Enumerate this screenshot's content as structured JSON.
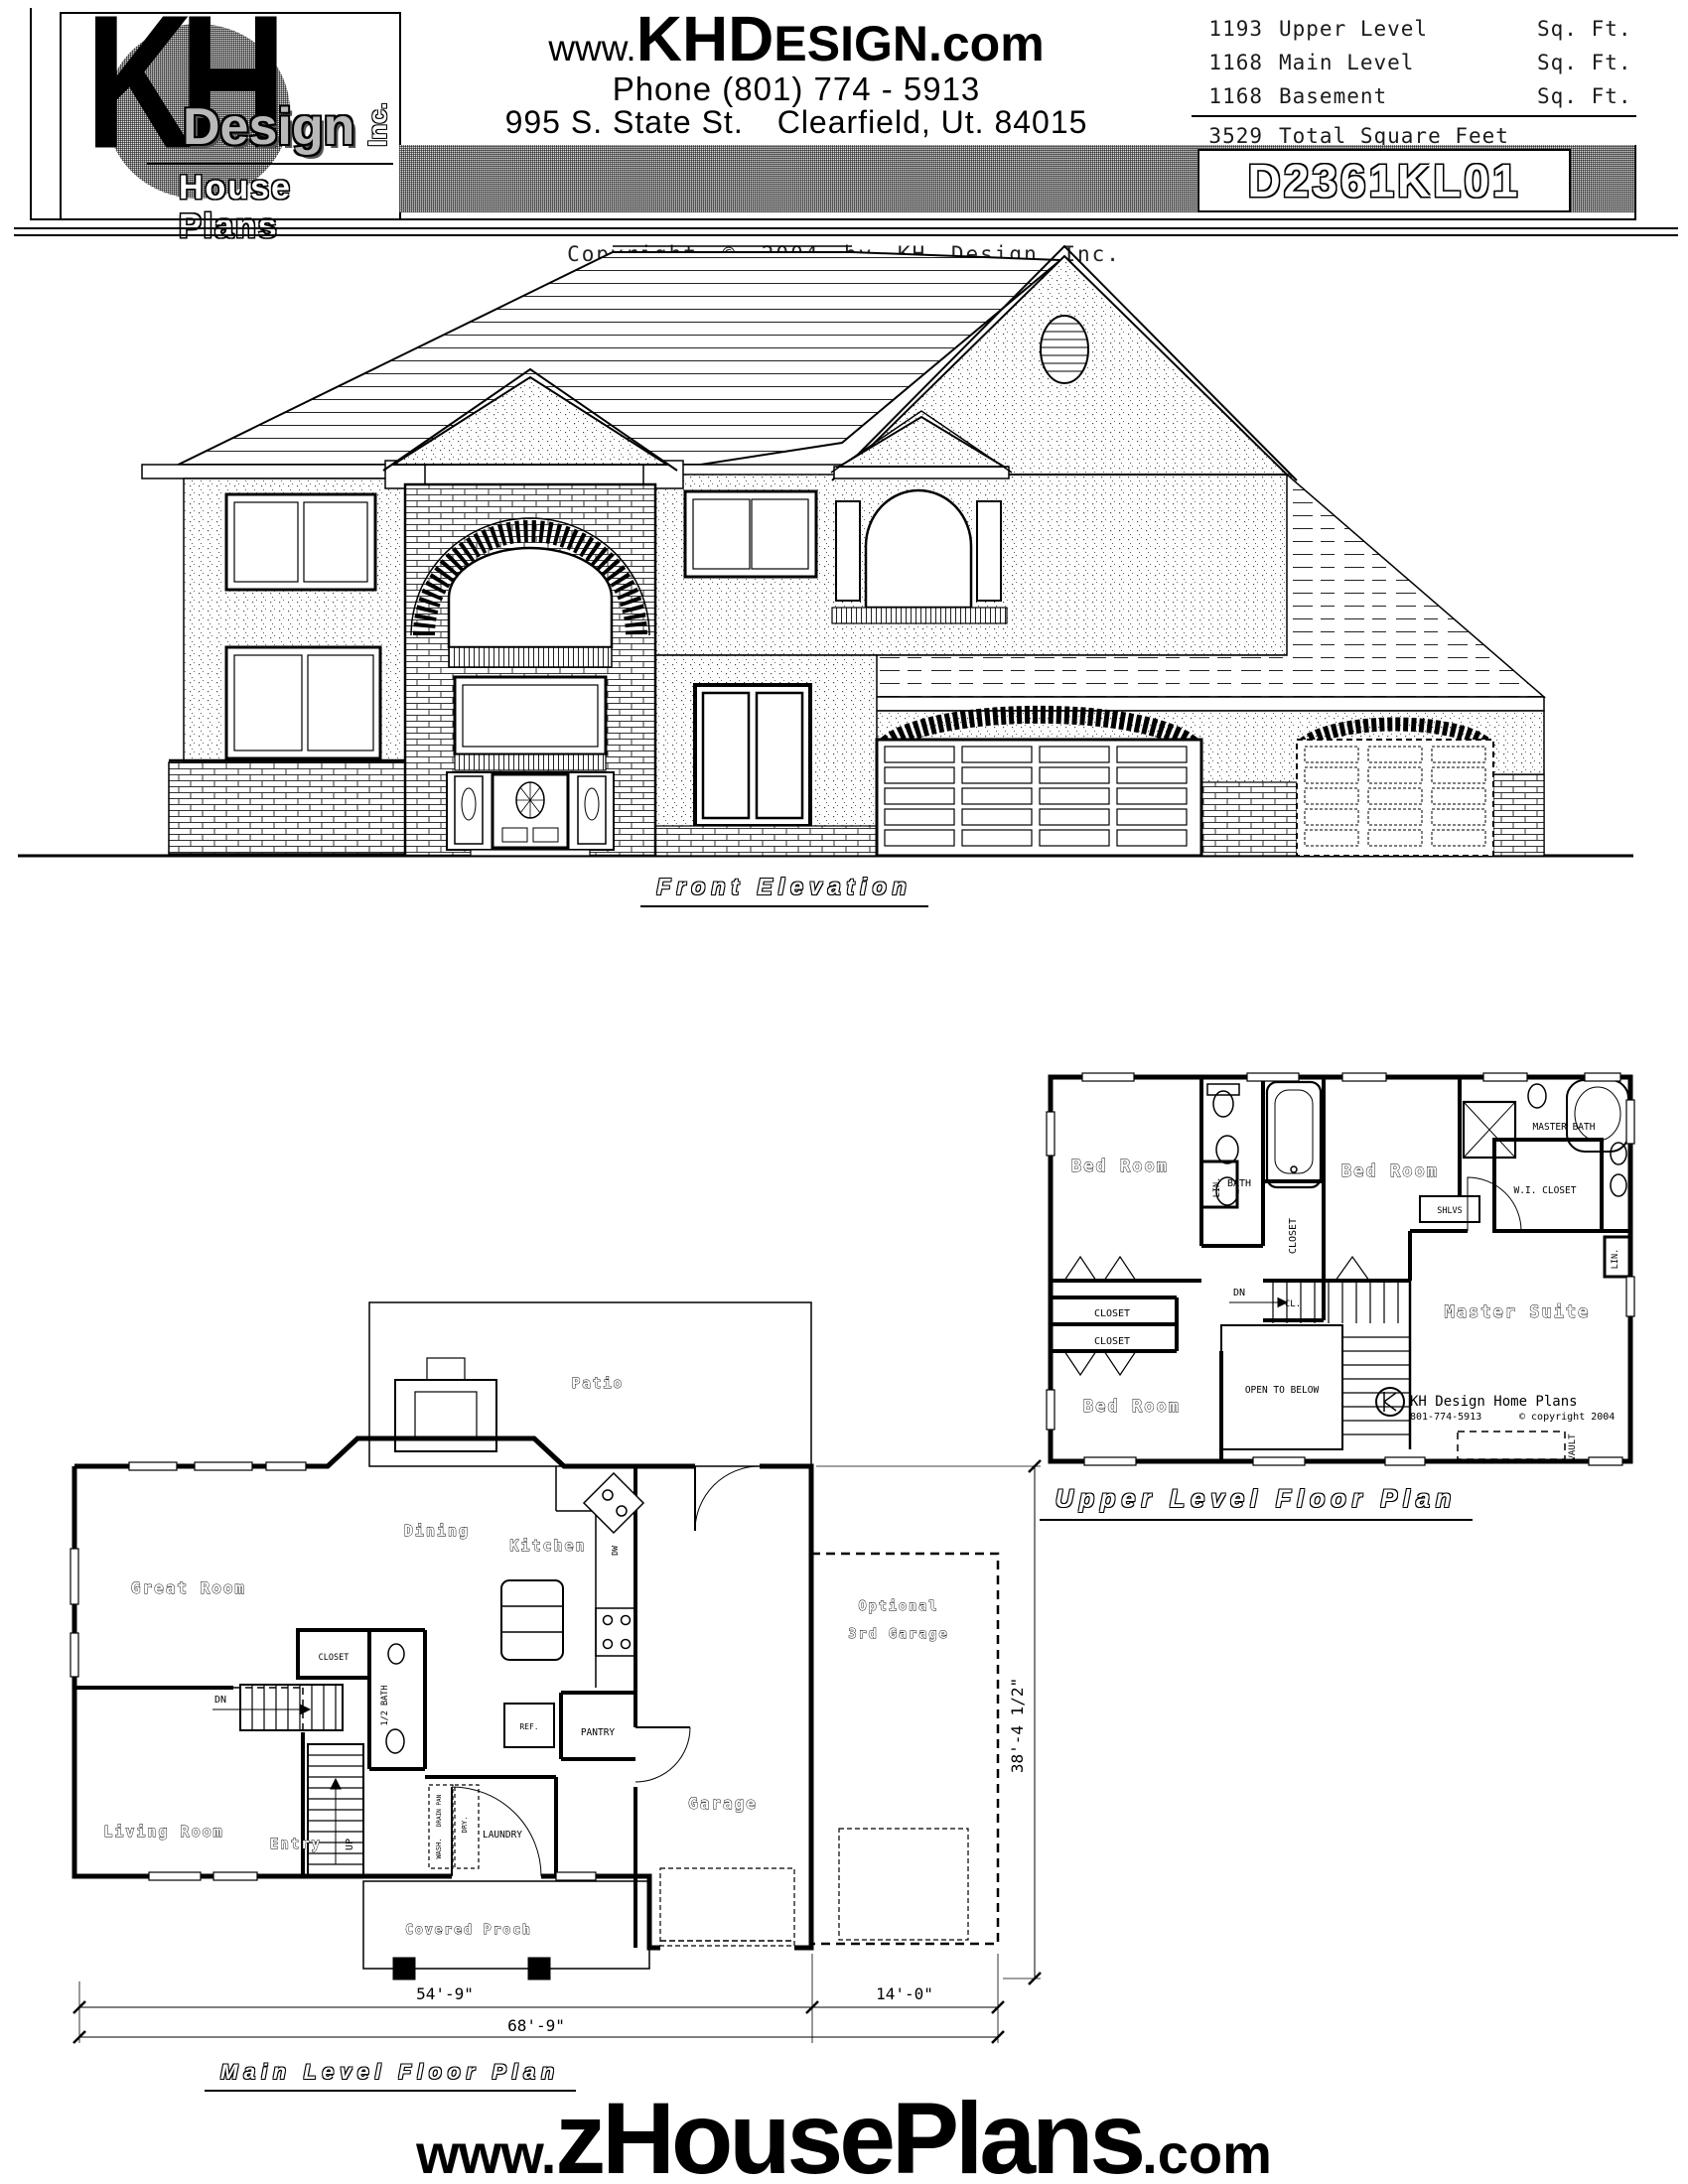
{
  "header": {
    "logo": {
      "kh": "KH",
      "design": "Design",
      "inc": "Inc.",
      "tagline": "House Plans"
    },
    "website": {
      "www": "www.",
      "khd": "KHD",
      "esign": "ESIGN",
      "com": ".com"
    },
    "phone": "Phone (801) 774 - 5913",
    "address_street": "995 S. State St.",
    "address_city": "Clearfield, Ut. 84015",
    "sqft": {
      "rows": [
        {
          "v": "1193",
          "label": "Upper Level",
          "unit": "Sq. Ft."
        },
        {
          "v": "1168",
          "label": "Main Level",
          "unit": "Sq. Ft."
        },
        {
          "v": "1168",
          "label": "Basement",
          "unit": "Sq. Ft."
        }
      ],
      "total": {
        "v": "3529",
        "label": "Total Square Feet"
      }
    },
    "plan_number": "D2361KL01"
  },
  "copyright": "Copyright © 2004 by KH Design Inc.",
  "elevation": {
    "caption": "Front Elevation"
  },
  "upper_plan": {
    "caption": "Upper Level Floor Plan",
    "rooms": {
      "bed_room": "Bed Room",
      "master_suite": "Master Suite",
      "bath": "BATH",
      "master_bath": "MASTER BATH",
      "wi_closet": "W.I. CLOSET",
      "closet": "CLOSET",
      "cl": "CL.",
      "lin": "LIN.",
      "shlvs": "SHLVS",
      "dn": "DN",
      "open_below": "OPEN TO BELOW",
      "vault": "VAULT"
    },
    "branding": {
      "name": "KH Design Home Plans",
      "phone": "801-774-5913",
      "copy": "© copyright 2004"
    }
  },
  "main_plan": {
    "caption": "Main Level Floor Plan",
    "rooms": {
      "patio": "Patio",
      "dining": "Dining",
      "kitchen": "Kitchen",
      "great_room": "Great Room",
      "living_room": "Living Room",
      "entry": "Entry",
      "garage": "Garage",
      "optional_1": "Optional",
      "optional_2": "3rd Garage",
      "covered_porch": "Covered Proch",
      "closet": "CLOSET",
      "half_bath": "1/2 BATH",
      "pantry": "PANTRY",
      "laundry": "LAUNDRY",
      "ref": "REF.",
      "dw": "DW",
      "dn": "DN",
      "up": "UP",
      "wash": "WASH.",
      "dry": "DRY.",
      "drain_pan": "DRAIN PAN"
    },
    "dims": {
      "main_width": "54'-9\"",
      "garage_width": "14'-0\"",
      "total_width": "68'-9\"",
      "depth": "38'-4 1/2\""
    }
  },
  "footer": {
    "www": "www.",
    "name": "zHousePlans",
    "com": ".com"
  }
}
